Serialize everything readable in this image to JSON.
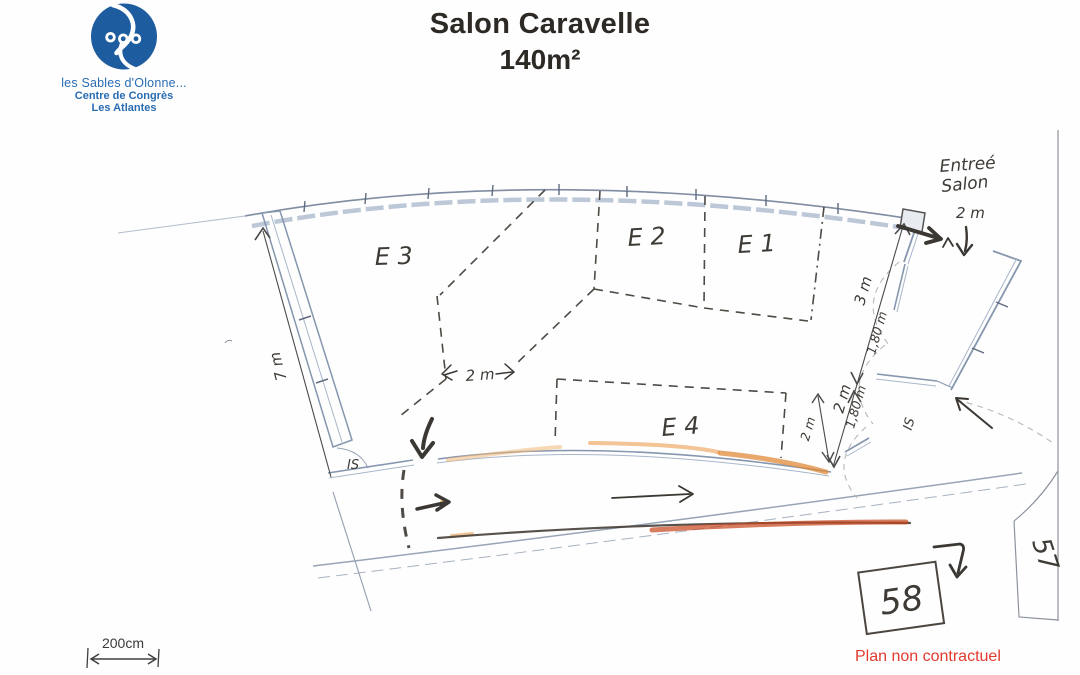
{
  "header": {
    "title": "Salon Caravelle",
    "area": "140m²"
  },
  "logo": {
    "org_line1": "les Sables d'Olonne...",
    "org_line2": "Centre de Congrès",
    "org_line3": "Les Atlantes",
    "brand_color": "#1d5c9e"
  },
  "plan": {
    "zones": [
      {
        "label": "E 3"
      },
      {
        "label": "E 2"
      },
      {
        "label": "E 1"
      },
      {
        "label": "E 4"
      }
    ],
    "entrance": {
      "line1": "Entreé",
      "line2": "Salon",
      "width": "2 m"
    },
    "dimensions": {
      "left_wall": "7 m",
      "center_gap": "2 m",
      "right_top": "3 m",
      "right_mid": "2 m",
      "right_bottom": "2 m",
      "door_width_1": "1,80 m",
      "door_width_2": "1,80 m"
    },
    "exits": {
      "left": "IS",
      "right": "IS"
    },
    "rooms": {
      "room_58": "58",
      "room_57": "57"
    }
  },
  "scale_bar": {
    "label": "200cm"
  },
  "footer": {
    "disclaimer": "Plan non contractuel"
  },
  "colors": {
    "wall_blue": "#8596ae",
    "wall_blue_light": "#a8b6ca",
    "pencil": "#3e3a35",
    "highlight_orange": "#e8a050",
    "highlight_red": "#c8441c",
    "disclaimer_red": "#e23a2e"
  }
}
